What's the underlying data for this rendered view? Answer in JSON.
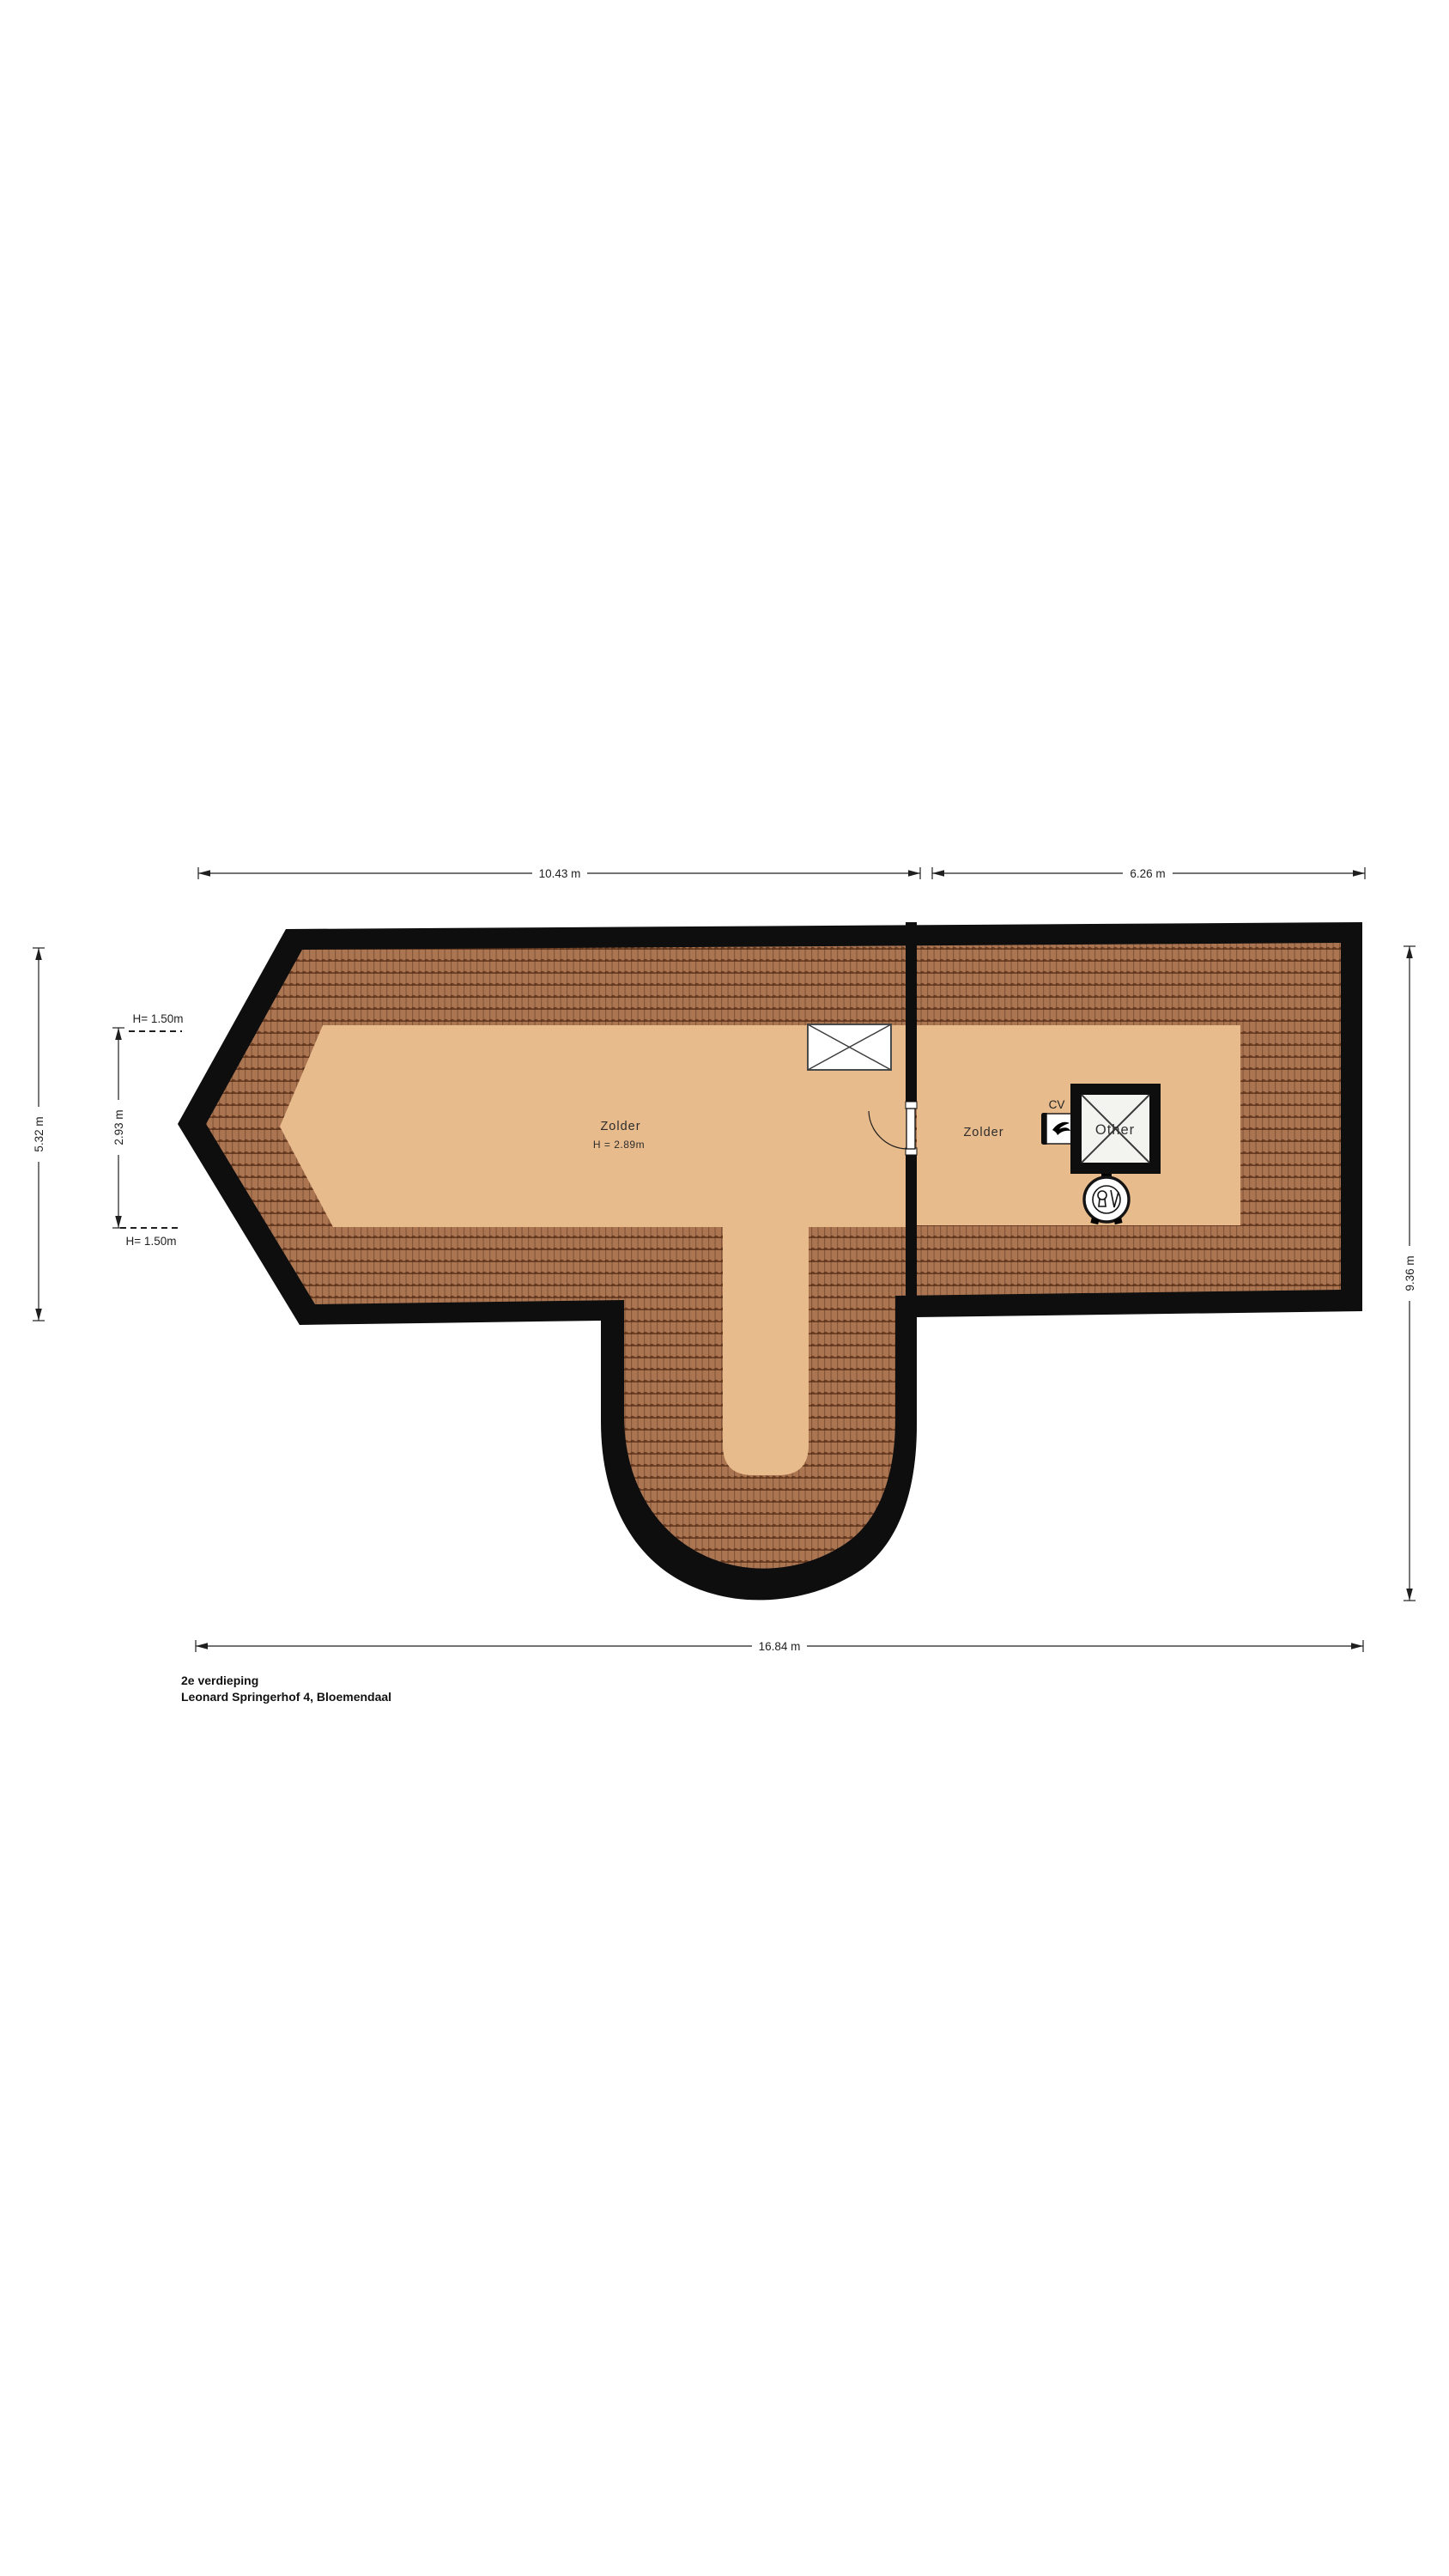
{
  "meta": {
    "floor_title": "2e verdieping",
    "address": "Leonard Springerhof 4, Bloemendaal"
  },
  "rooms": {
    "zolder_left": {
      "name": "Zolder",
      "height": "H = 2.89m"
    },
    "zolder_right": {
      "name": "Zolder"
    },
    "cv_label": "CV",
    "shaft_label": "Other"
  },
  "dimensions": {
    "top_left": "10.43 m",
    "top_right": "6.26 m",
    "bottom": "16.84 m",
    "left_outer": "5.32 m",
    "left_inner": "2.93 m",
    "right": "9.36 m",
    "h_top": "H= 1.50m",
    "h_bottom": "H= 1.50m"
  },
  "colors": {
    "wall": "#0e0e0e",
    "floor": "#e8bb8c",
    "tile_base": "#ab7552",
    "tile_dark": "#5a3018",
    "shaft_inner": "#f3f3f0",
    "white": "#ffffff",
    "window_frame": "#4a4a4a",
    "cross_line": "#3a3a3a"
  }
}
